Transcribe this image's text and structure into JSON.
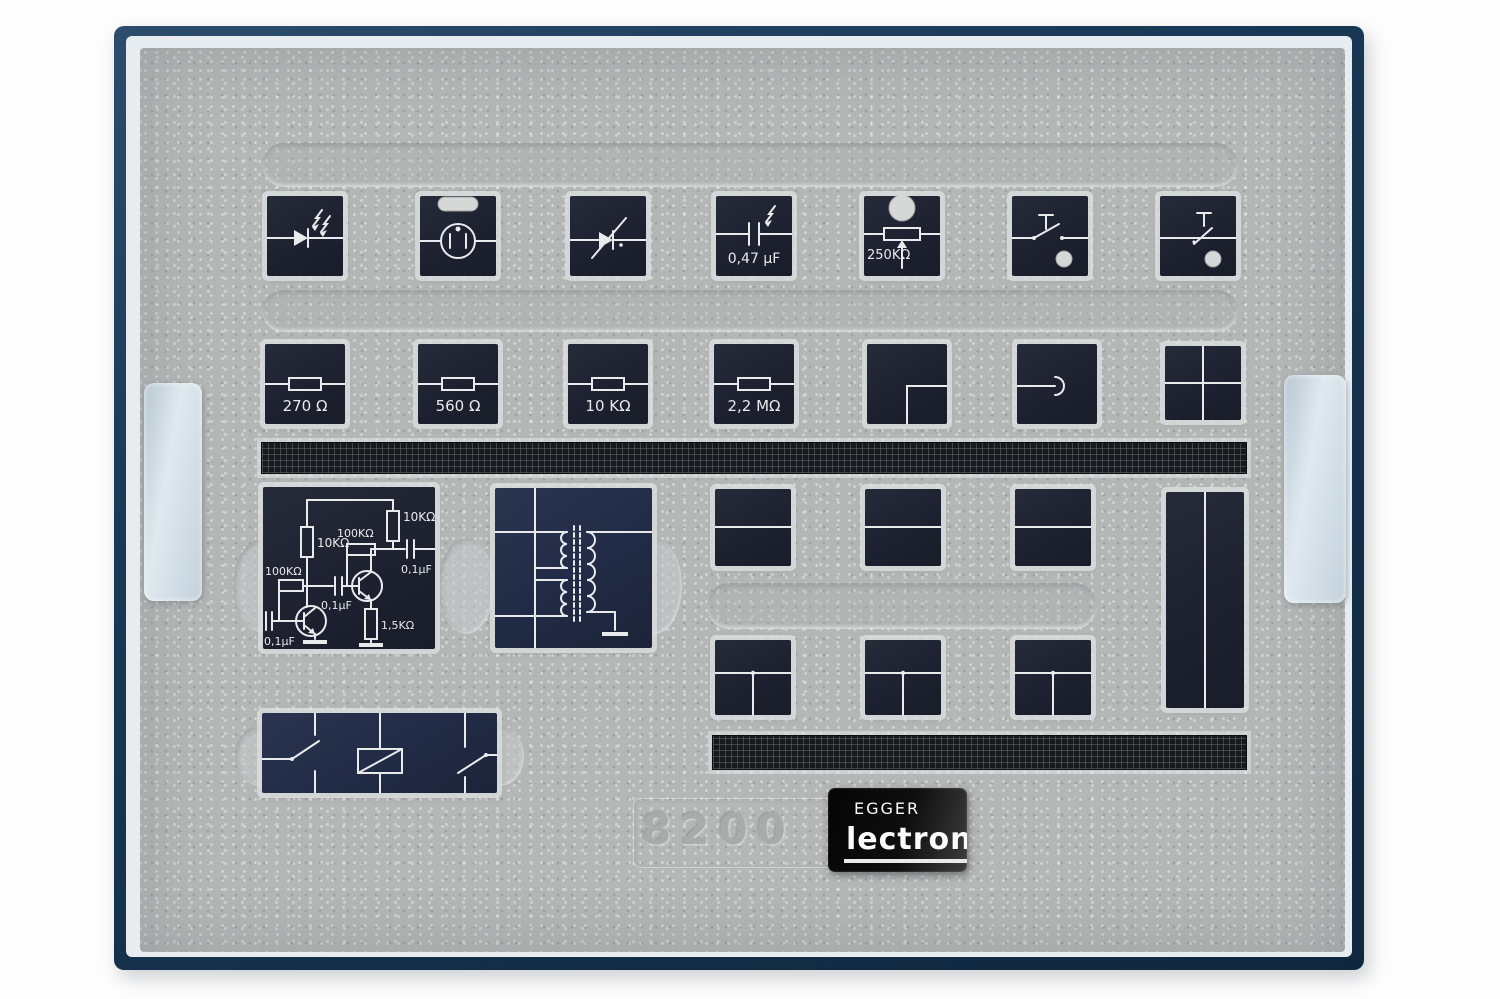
{
  "scene": {
    "subject": "Electronics experiment kit box: blue tray with grey foam insert holding black circuit-symbol building blocks",
    "embossed": {
      "code": "8200"
    }
  },
  "badge": {
    "maker": "EGGER",
    "brand": "lectron"
  },
  "colors": {
    "background": "#fdfdfd",
    "box_frame": "#1a3a57",
    "inner_rim": "#e7ecf0",
    "foam": "#b4b7b6",
    "block": "#1d2130",
    "block_navy": "#212b45",
    "symbol": "#e9eaec",
    "grid_strip": "#17191d",
    "handle": "#cfdbe4",
    "badge_bg": "#0e0e0e",
    "badge_text": "#f2f2f2"
  },
  "row1": [
    {
      "name": "led-diode-block",
      "label": null
    },
    {
      "name": "lamp-block",
      "label": null
    },
    {
      "name": "photo-diode-block",
      "label": null
    },
    {
      "name": "capacitor-block",
      "label": "0,47 µF"
    },
    {
      "name": "potentiometer-block",
      "label": "250KΩ"
    },
    {
      "name": "pushbutton-block",
      "label": null
    },
    {
      "name": "pushbutton-break-block",
      "label": null
    }
  ],
  "row2": [
    {
      "name": "resistor-block",
      "label": "270 Ω"
    },
    {
      "name": "resistor-block",
      "label": "560 Ω"
    },
    {
      "name": "resistor-block",
      "label": "10 KΩ"
    },
    {
      "name": "resistor-block",
      "label": "2,2 MΩ"
    },
    {
      "name": "corner-wire-block",
      "label": null
    },
    {
      "name": "contact-hook-block",
      "label": null
    },
    {
      "name": "cross-wire-block",
      "label": null
    }
  ],
  "amplifier_block": {
    "r_collector_left": "10KΩ",
    "r_feedback_left": "100KΩ",
    "c_input": "0,1µF",
    "c_coupling": "0,1µF",
    "r_feedback_mid": "100KΩ",
    "r_collector_right": "10KΩ",
    "c_output": "0,1µF",
    "r_emitter": "1,5KΩ"
  }
}
